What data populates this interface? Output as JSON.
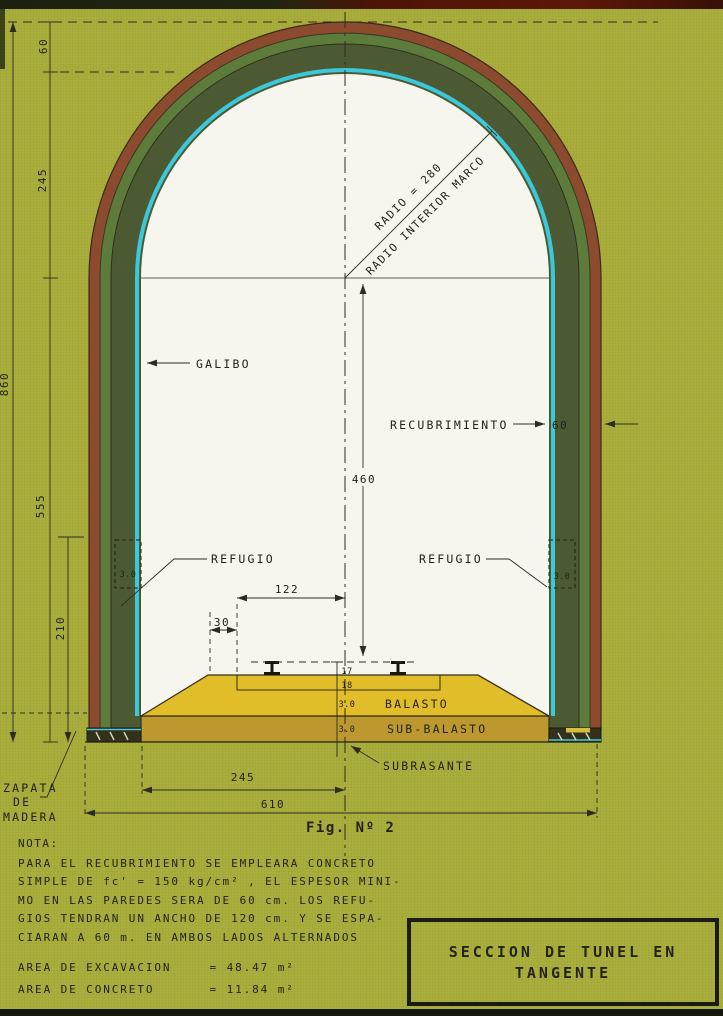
{
  "page": {
    "caption": "Fig. Nº 2"
  },
  "title_box": {
    "line1": "SECCION DE TUNEL EN",
    "line2": "TANGENTE"
  },
  "labels": {
    "galibo": "GALIBO",
    "recubrimiento": "RECUBRIMIENTO",
    "refugio_left": "REFUGIO",
    "refugio_right": "REFUGIO",
    "radio": "RADIO = 280",
    "radio_interior": "RADIO INTERIOR MARCO",
    "balasto": "BALASTO",
    "sub_balasto": "SUB-BALASTO",
    "subrasante": "SUBRASANTE",
    "zapata_1": "ZAPATA",
    "zapata_2": "DE",
    "zapata_3": "MADERA"
  },
  "dimensions": {
    "top_cover": "60",
    "arch_rise": "245",
    "overall_height": "860",
    "wall_height": "555",
    "lower_height": "210",
    "clear_height": "460",
    "half_gauge": "122",
    "shoulder": "30",
    "wall_thickness": "60",
    "rail_height": "17",
    "ballast_top": "18",
    "ballast_layer": "3.0",
    "sub_ballast_layer": "3.0",
    "niche_left": "3.0",
    "niche_right": "3.0",
    "base_half_width": "245",
    "base_width": "610"
  },
  "note": {
    "heading": "NOTA:",
    "lines": [
      "PARA EL RECUBRIMIENTO SE EMPLEARA CONCRETO",
      "SIMPLE DE fc' = 150 kg/cm² , EL ESPESOR MINI-",
      "MO EN LAS PAREDES SERA DE 60 cm. LOS REFU-",
      "GIOS TENDRAN UN ANCHO DE 120 cm. Y SE ESPA-",
      "CIARAN A 60 m. EN AMBOS LADOS ALTERNADOS"
    ],
    "areas": [
      {
        "label": "AREA DE EXCAVACION",
        "value": "= 48.47 m²"
      },
      {
        "label": "AREA DE CONCRETO",
        "value": "= 11.84 m²"
      }
    ]
  },
  "colors": {
    "background": "#a6b03c",
    "lining_outer": "#8c4a2e",
    "lining_mid": "#5d7c3c",
    "lining_concrete": "#4c5a33",
    "interior": "#f6f6ee",
    "interior_edge": "#3cc8dc",
    "ballast": "#e2bd2a",
    "sub_ballast": "#bd982e",
    "ink": "#2e2c20"
  }
}
